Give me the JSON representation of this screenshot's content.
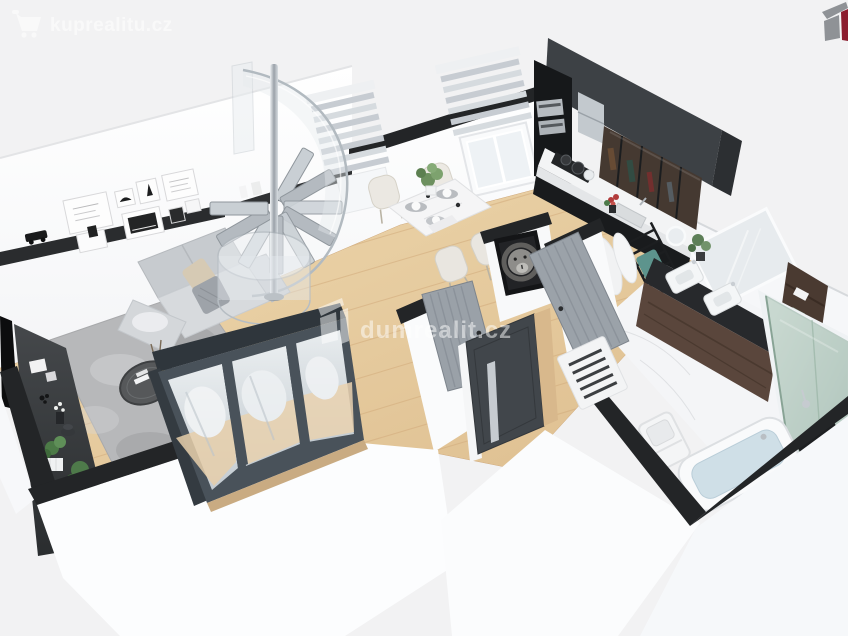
{
  "meta": {
    "kind": "3d-floor-plan-render",
    "description": "Isometric cutaway 3D rendering of a small apartment floor plan (real-estate listing visual)"
  },
  "watermarks": {
    "top_left": {
      "text": "kuprealitu.cz"
    },
    "center": {
      "text": "dumrealit.cz"
    }
  },
  "brand": {
    "corner_logo": "dumrealit-box-logo",
    "maroon": "#8c1d2f",
    "logo_gray": "#8f9296",
    "watermark_color": "#ffffff"
  },
  "palette": {
    "background": "#f2f2f3",
    "wall_white": "#ffffff",
    "wall_top_dark": "#232527",
    "wood_floor": "#e6cda2",
    "wood_line": "#cfa97c",
    "marble_floor": "#f4f5f7",
    "kitchen_panel": "#3d4145",
    "cabinet_black": "#17191b",
    "glass_cabinet": "#453931",
    "counter_white": "#f3f4f5",
    "sofa_gray": "#d7dadd",
    "rug_gray": "#b7b8ba",
    "wardrobe_frame": "#49525a",
    "door_gray": "#9aa1a8",
    "front_door": "#41464b",
    "oak_threshold": "#d8b88c",
    "vanity_wood": "#5a463c",
    "towel_teal": "#5d948d",
    "shower_glass": "#8fae9d",
    "bath_water": "#cfdfe7",
    "plant_green": "#5d8455",
    "chrome": "#c6cbd0"
  },
  "scene": {
    "rooms": [
      {
        "name": "living-room",
        "objects": [
          "l-shaped-sofa",
          "shag-rug",
          "round-coffee-table",
          "tv-sideboard",
          "wall-tv",
          "mirrored-sliding-wardrobe",
          "picture-ledge",
          "picture-frames-x8",
          "spiral-staircase",
          "corner-plants"
        ]
      },
      {
        "name": "dining-area",
        "objects": [
          "marble-dining-table",
          "dining-chairs-x4",
          "plant-centerpiece",
          "window-with-blinds-x2",
          "place-settings"
        ]
      },
      {
        "name": "kitchen",
        "objects": [
          "black-cabinets",
          "white-countertop",
          "cooktop-with-pots",
          "oven-stack",
          "chrome-hood",
          "glass-display-cabinets",
          "sink"
        ]
      },
      {
        "name": "hallway",
        "objects": [
          "front-door-with-steel-handle",
          "interior-doors-x2",
          "lion-artwork",
          "white-vent-grille"
        ]
      },
      {
        "name": "bathroom",
        "objects": [
          "double-sink-vanity",
          "large-mirror",
          "round-mirror",
          "black-towel-ladder",
          "teal-towel",
          "bathrobes",
          "wooden-shelf-unit",
          "glass-shower",
          "bathtub",
          "toilet",
          "marble-floor"
        ]
      }
    ]
  }
}
